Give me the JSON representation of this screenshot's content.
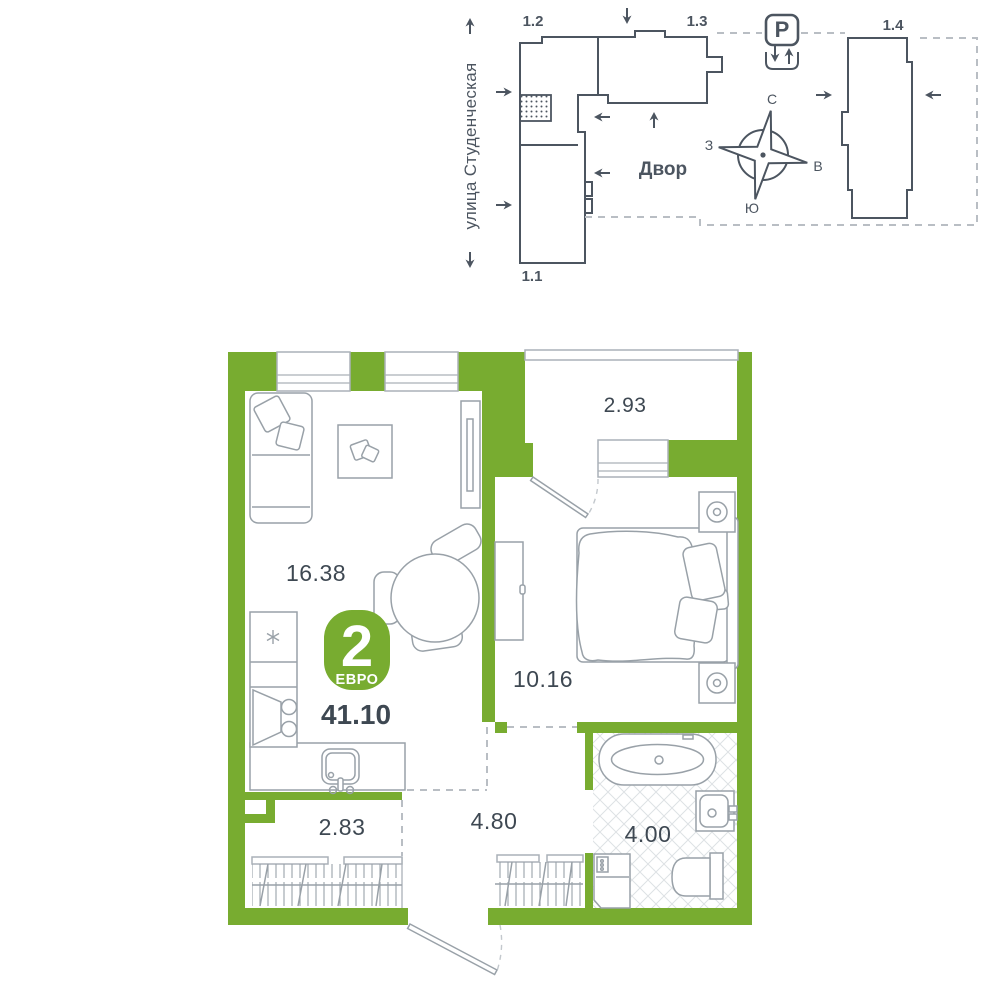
{
  "colors": {
    "wall_green": "#78AC30",
    "outline_dark": "#4C5560",
    "text_dark": "#3E4852",
    "furniture_gray": "#99A1A8",
    "dashed_gray": "#B9BEC4"
  },
  "site_plan": {
    "street_label": "улица Студенческая",
    "courtyard_label": "Двор",
    "parking": {
      "label": "P"
    },
    "compass": {
      "north": "С",
      "south": "Ю",
      "west": "З",
      "east": "В"
    },
    "buildings": [
      {
        "label": "1.1"
      },
      {
        "label": "1.2"
      },
      {
        "label": "1.3"
      },
      {
        "label": "1.4"
      }
    ]
  },
  "floor_plan": {
    "badge": {
      "rooms": "2",
      "type": "ЕВРО",
      "total_area": "41.10"
    },
    "rooms": [
      {
        "name": "kitchen-living",
        "area": "16.38"
      },
      {
        "name": "bedroom",
        "area": "10.16"
      },
      {
        "name": "balcony",
        "area": "2.93"
      },
      {
        "name": "wardrobe",
        "area": "2.83"
      },
      {
        "name": "hallway",
        "area": "4.80"
      },
      {
        "name": "bathroom",
        "area": "4.00"
      }
    ]
  }
}
